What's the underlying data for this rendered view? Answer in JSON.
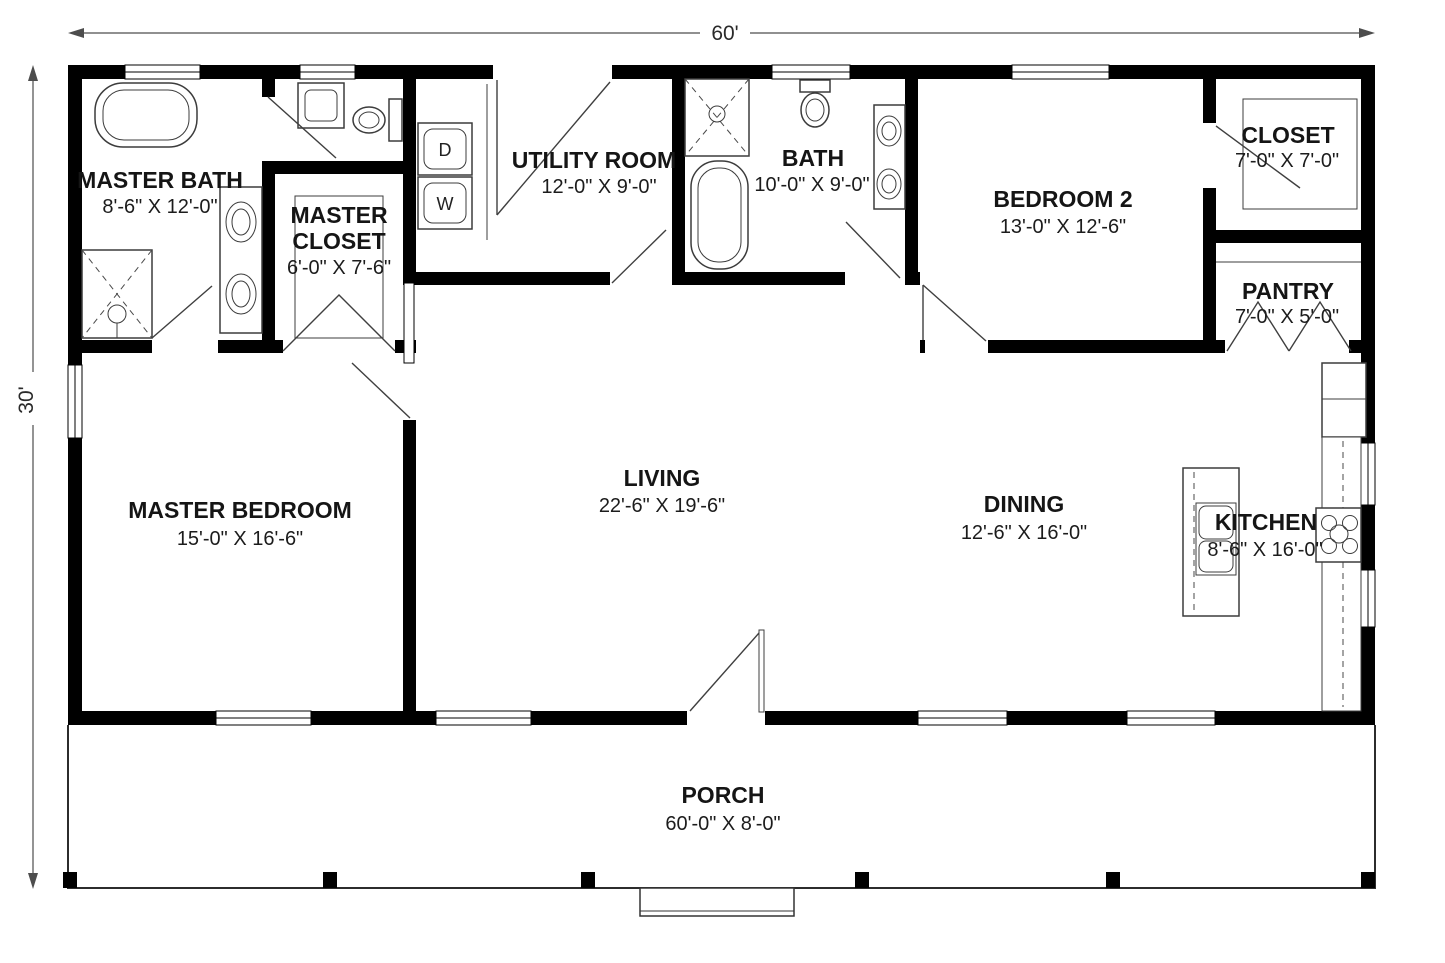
{
  "plan": {
    "overall_width": "60'",
    "overall_depth": "30'"
  },
  "rooms": {
    "master_bath": {
      "name": "MASTER BATH",
      "dims": "8'-6\" X 12'-0\""
    },
    "master_closet": {
      "name_line1": "MASTER",
      "name_line2": "CLOSET",
      "dims": "6'-0\" X 7'-6\""
    },
    "utility": {
      "name": "UTILITY ROOM",
      "dims": "12'-0\" X 9'-0\""
    },
    "bath": {
      "name": "BATH",
      "dims": "10'-0\" X 9'-0\""
    },
    "bedroom2": {
      "name": "BEDROOM 2",
      "dims": "13'-0\" X 12'-6\""
    },
    "closet": {
      "name": "CLOSET",
      "dims": "7'-0\" X 7'-0\""
    },
    "pantry": {
      "name": "PANTRY",
      "dims": "7'-0\" X 5'-0\""
    },
    "master_bedroom": {
      "name": "MASTER BEDROOM",
      "dims": "15'-0\" X 16'-6\""
    },
    "living": {
      "name": "LIVING",
      "dims": "22'-6\" X 19'-6\""
    },
    "dining": {
      "name": "DINING",
      "dims": "12'-6\" X 16'-0\""
    },
    "kitchen": {
      "name": "KITCHEN",
      "dims": "8'-6\" X 16'-0\""
    },
    "porch": {
      "name": "PORCH",
      "dims": "60'-0\" X 8'-0\""
    }
  },
  "appliances": {
    "dryer": "D",
    "washer": "W"
  },
  "colors": {
    "wall": "#000000",
    "background": "#ffffff",
    "text": "#151515"
  }
}
